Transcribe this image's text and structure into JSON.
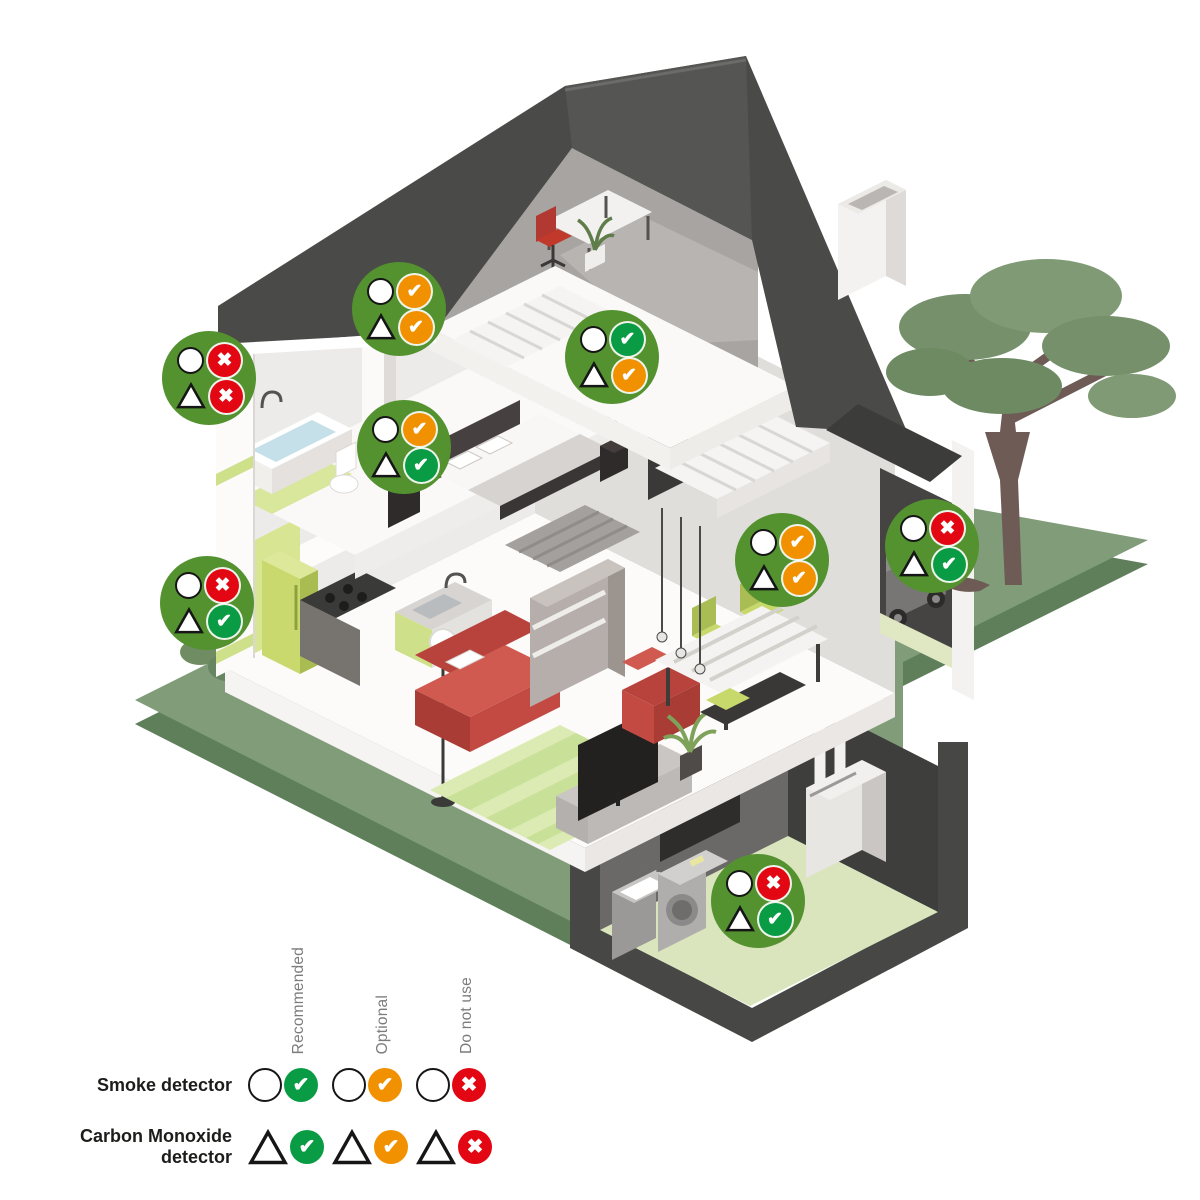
{
  "legend": {
    "columns": [
      {
        "id": "recommended",
        "label": "Recommended"
      },
      {
        "id": "optional",
        "label": "Optional"
      },
      {
        "id": "do_not_use",
        "label": "Do not use"
      }
    ],
    "rows": [
      {
        "id": "smoke",
        "label": "Smoke detector",
        "symbol": "circle"
      },
      {
        "id": "co",
        "label": "Carbon Monoxide detector",
        "symbol": "triangle"
      }
    ]
  },
  "status_colors": {
    "recommended": "#0A9B45",
    "optional": "#F29100",
    "do_not_use": "#E30613"
  },
  "status_glyphs": {
    "recommended": "✔",
    "optional": "✔",
    "do_not_use": "✖"
  },
  "badge_color": "#549230",
  "symbol_meanings": {
    "circle": "Smoke detector",
    "triangle": "Carbon Monoxide detector"
  },
  "badges": [
    {
      "room": "attic",
      "smoke": "optional",
      "co": "optional",
      "x": 399,
      "y": 309
    },
    {
      "room": "bathroom-wall",
      "smoke": "do_not_use",
      "co": "do_not_use",
      "x": 209,
      "y": 378
    },
    {
      "room": "upstairs-landing",
      "smoke": "recommended",
      "co": "optional",
      "x": 612,
      "y": 357
    },
    {
      "room": "bedroom",
      "smoke": "optional",
      "co": "recommended",
      "x": 404,
      "y": 447
    },
    {
      "room": "kitchen",
      "smoke": "do_not_use",
      "co": "recommended",
      "x": 207,
      "y": 603
    },
    {
      "room": "living-dining-room",
      "smoke": "optional",
      "co": "optional",
      "x": 782,
      "y": 560
    },
    {
      "room": "garage",
      "smoke": "do_not_use",
      "co": "recommended",
      "x": 932,
      "y": 546
    },
    {
      "room": "basement",
      "smoke": "do_not_use",
      "co": "recommended",
      "x": 758,
      "y": 901
    }
  ]
}
